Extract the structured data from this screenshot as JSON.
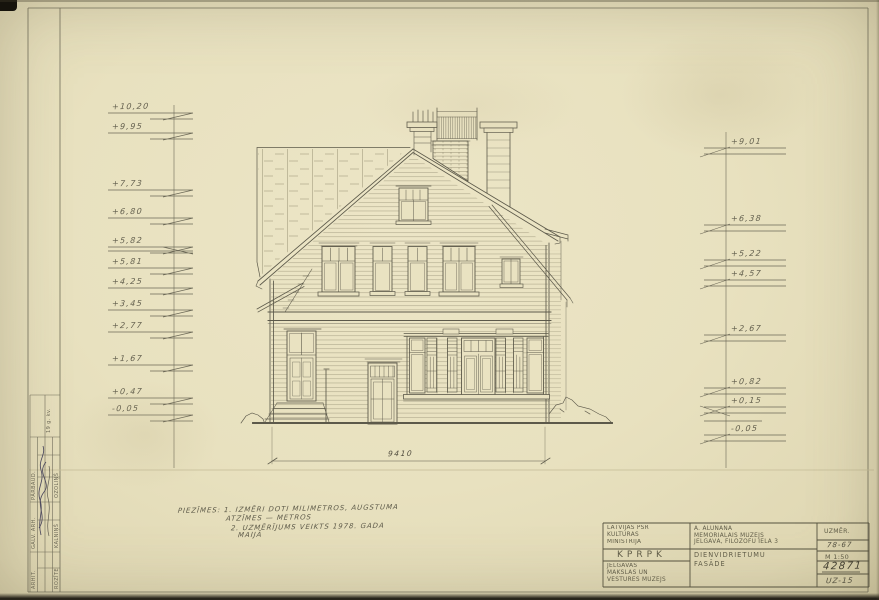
{
  "sheet": {
    "dimension_label": "9410",
    "notes": {
      "line1": "PIEZĪMES: 1. IZMĒRI DOTI MILIMETROS, AUGSTUMA",
      "line2": "ATZĪMES — METROS",
      "line3": "2. UZMĒRĪJUMS VEIKTS 1978. GADA",
      "line4": "MAIJĀ"
    }
  },
  "levels": {
    "left": [
      {
        "label": "+10,20"
      },
      {
        "label": "+9,95"
      },
      {
        "label": "+7,73"
      },
      {
        "label": "+6,80"
      },
      {
        "label": "+5,82"
      },
      {
        "label": "+5,81"
      },
      {
        "label": "+4,25"
      },
      {
        "label": "+3,45"
      },
      {
        "label": "+2,77"
      },
      {
        "label": "+1,67"
      },
      {
        "label": "+0,47"
      },
      {
        "label": "-0,05"
      }
    ],
    "right": [
      {
        "label": "+9,01"
      },
      {
        "label": "+6,38"
      },
      {
        "label": "+5,22"
      },
      {
        "label": "+4,57"
      },
      {
        "label": "+2,67"
      },
      {
        "label": "+0,82"
      },
      {
        "label": "+0,15"
      },
      {
        "label": "-0,05"
      }
    ]
  },
  "title_block": {
    "organization": {
      "line1": "LATVIJAS PSR",
      "line2": "KULTŪRAS",
      "line3": "MINISTRIJA"
    },
    "org_abbr": "KPRPK",
    "museum": {
      "line1": "JELGAVAS",
      "line2": "MĀKSLAS UN",
      "line3": "VĒSTURES MUZEJS"
    },
    "object": {
      "line1": "A. ALUNĀNA",
      "line2": "MEMORIĀLAIS MUZEJS",
      "line3": "JELGAVĀ, FILOZOFU IELĀ 3"
    },
    "drawing": {
      "line1": "DIENVIDRIETUMU",
      "line2": "FASĀDE"
    },
    "labels": {
      "survey": "UZMĒR.",
      "object_no": "78-67",
      "scale": "M 1:50",
      "inventory_no": "42871",
      "sheet_no": "UZ-15"
    }
  },
  "signoff": {
    "date_note": "19 g. kv.",
    "rows": [
      {
        "role": "PĀRBAUD.",
        "name": "OZOLIŅŠ"
      },
      {
        "role": "GALV. ARH.",
        "name": "KALNIŅŠ"
      },
      {
        "role": "ARHIT.",
        "name": "ROZĪTE"
      }
    ]
  },
  "colors": {
    "paper": "#e8e1bf",
    "ink": "#5c594a",
    "pencil": "#504d3e",
    "signature_ink": "#3d3a56"
  }
}
